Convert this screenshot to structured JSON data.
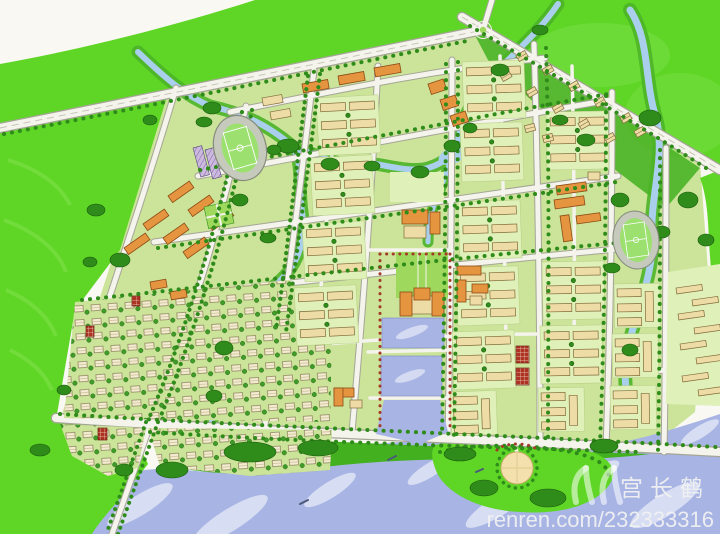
{
  "meta": {
    "description": "Hand-drawn bird's-eye urban master plan rendering with greenbelt, river and canal-town street grid"
  },
  "watermark": {
    "owner": "宫长鹤",
    "url": "renren.com/232333316",
    "logo": "renren-logo"
  },
  "features": [
    "perimeter greenbelt",
    "diagonal highway with roundabout",
    "west stadium",
    "east stadium",
    "west school campus with orange halls",
    "east campus",
    "central civic axis with plaza and twin lakes",
    "canal outlet to riverfront",
    "residential slab-block quarters",
    "southwest villa district",
    "northeast villa cluster",
    "east industrial strip",
    "south riverside park",
    "circular plaza",
    "meandering streams",
    "wide main river"
  ],
  "colors": {
    "paper": "#f9f8f3",
    "greenBright": "#5fd626",
    "greenMid": "#43b01f",
    "tree": "#2f8c1a",
    "treeOutline": "#1a5a0c",
    "lawn": "#cbe49a",
    "lawnLight": "#dff0b8",
    "plazaLawn": "#9ed95e",
    "water": "#a7b4e4",
    "stream": "#a9cfec",
    "streamBank": "#4cb428",
    "road": "#f4f3ec",
    "roadEdge": "#a5a596",
    "building": "#eedca6",
    "buildingOutline": "#806c3a",
    "orange": "#e59440",
    "orangeOutline": "#8d4c14",
    "red": "#ae3322",
    "redTree": "#a33a28",
    "track": "#c6cabc",
    "field": "#9ce070",
    "plaza": "#f3e0ac",
    "watermark": "#f2f2f2"
  }
}
